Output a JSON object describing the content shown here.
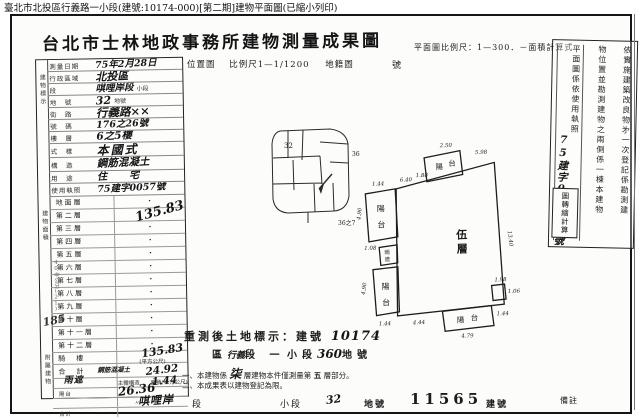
{
  "caption": "臺北市北投區行義路一小段(建號:10174-000)[第二期]建物平面圖(已縮小列印)",
  "doc": {
    "title": "台北市士林地政事務所建物測量成果圖",
    "plan_scale": "平面圖比例尺：1—300．",
    "area_calc": "－面積計算式",
    "location_label": "位置圖",
    "location_scale": "比例尺1—1/1200",
    "cadastral_label": "地籍圖",
    "sheet_label": "號"
  },
  "form": {
    "strip_top": "建物標示",
    "strip_mid": "建物面積",
    "strip_bottom": "附屬建物",
    "rows": [
      {
        "label": "測量日期",
        "value": "75年2月28日",
        "suffix": "日"
      },
      {
        "label": "行政區域",
        "value": "北投區",
        "suffix": ""
      },
      {
        "label": "段",
        "value": "唭哩岸段",
        "suffix": "小段"
      },
      {
        "label": "地　號",
        "value": "32",
        "suffix": "地號"
      },
      {
        "label": "街　路",
        "value": "行義路××",
        "suffix": ""
      },
      {
        "label": "號　碼",
        "value": "176之26號",
        "suffix": ""
      },
      {
        "label": "樓　層",
        "value": "6之5樓",
        "suffix": ""
      },
      {
        "label": "式　樣",
        "value": "本國式",
        "suffix": ""
      },
      {
        "label": "構　造",
        "value": "鋼筋混凝土",
        "suffix": ""
      },
      {
        "label": "用　途",
        "value": "住　宅",
        "suffix": ""
      },
      {
        "label": "使用執照",
        "value": "75建字0057號",
        "suffix": ""
      }
    ]
  },
  "areas": {
    "floors": [
      "地面層",
      "第二層",
      "第三層",
      "第四層",
      "第五層",
      "第六層",
      "第七層",
      "第八層",
      "第九層",
      "第十層",
      "第十一層",
      "第十二層"
    ],
    "dot": "・",
    "fifth_value": "135.83",
    "arcade_label": "騎　樓",
    "total_label": "合　計",
    "total_value": "135.83",
    "unit_note": "(平方公尺)"
  },
  "annex": {
    "section_label": "附屬建物",
    "col_structure": "主體構造",
    "col_area": "面積(平方公尺)",
    "rows": [
      {
        "use": "陽台",
        "structure": "鋼筋混凝土",
        "area": "24.92"
      },
      {
        "use": "雨遮",
        "structure": "〃",
        "area": "1.44"
      },
      {
        "use": "合計",
        "structure": "",
        "area": "26.36"
      }
    ]
  },
  "plan": {
    "floor_char1": "伍",
    "floor_char2": "層",
    "balcony_h1": "陽",
    "balcony_h2": "台",
    "rain1": "雨",
    "rain2": "遮",
    "dims": {
      "top_w": "2.50",
      "top_right": "5.98",
      "top_mid": "1.88",
      "top_left": "6.40",
      "ub_top": "1.44",
      "ub_side": "4.90",
      "rain_d": "1.08",
      "lb_side": "4.90",
      "lb_bottom": "1.44",
      "bottom_seg": "4.44",
      "bb_w": "4.79",
      "bb_right": "1.44",
      "right_side": "13.40",
      "notch_a": "1.98",
      "notch_b": "1.06"
    }
  },
  "sketch": {
    "p1": "32",
    "p2": "36",
    "p3": "36之7"
  },
  "remeasure": {
    "line1_label": "重測後土地標示：建號",
    "line1_value": "10174",
    "district": "區",
    "district_hand": "行義",
    "duan": "段",
    "xiao_hand": "一",
    "xiaoduan": "小段",
    "lot_hand": "360",
    "lot_label": "地號",
    "note1_a": "一、本建物係",
    "note1_hand": "柒",
    "note1_b": "層建物本件僅測量第",
    "note1_c": "五",
    "note1_d": "層部分。",
    "note2": "二、本成果表以建物登記為限。"
  },
  "bottom": {
    "section_hand": "唭哩岸",
    "duan": "段",
    "xiaoduan": "小段",
    "lot_hand": "32",
    "lot_label": "地號",
    "bldg_no": "11565",
    "bldg_label": "建號",
    "remark": "備註"
  },
  "side_notes": {
    "col1": "依實施建築改良物㐧一次登記係勘測建",
    "col2": "物位置並勘測建物之兩側係一棟本建物",
    "col3": "平面圖係依使用執照",
    "col3_hand": "75建字0057號",
    "stamp": "圖轉繪計算"
  },
  "margin": {
    "hand_num": "185",
    "note": "40中公分(21)"
  }
}
